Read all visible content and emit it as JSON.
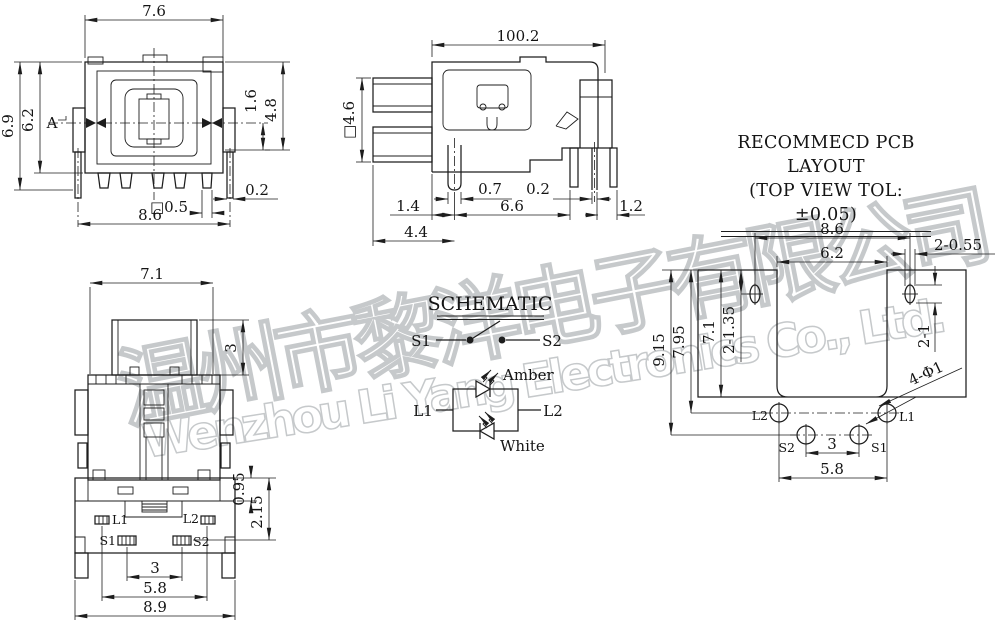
{
  "style": {
    "line_color": "#1d1d1d",
    "watermark_color": "#c6c9cb",
    "background": "#ffffff"
  },
  "watermark": {
    "zh": "温州市黎洋电子有限公司",
    "en": "Wenzhou Li Yang Electronics Co., Ltd."
  },
  "front_view": {
    "dim_top_width": "7.6",
    "dim_total_height": "6.9",
    "dim_body_height": "6.2",
    "section_label": "A",
    "dim_pin_drop": "1.6",
    "dim_flange_height": "4.8",
    "dim_pin_width": "0.2",
    "dim_square_pin": "□0.5",
    "dim_pin_span": "8.6"
  },
  "side_view": {
    "dim_total_length": "100.2",
    "dim_square_button": "□4.6",
    "dim_post_width": "0.7",
    "dim_pin_thickness": "0.2",
    "dim_left_offset": "1.4",
    "dim_pin_pitch": "6.6",
    "dim_right_offset": "1.2",
    "dim_front_depth": "4.4"
  },
  "bottom_view": {
    "dim_top_width": "7.1",
    "dim_button_height": "3",
    "dim_led_row_offset": "0.95",
    "dim_switch_row_offset": "2.15",
    "dim_switch_pitch": "3",
    "dim_led_pitch": "5.8",
    "dim_base_width": "8.9",
    "pin_labels": {
      "l1": "L1",
      "l2": "L2",
      "s1": "S1",
      "s2": "S2"
    }
  },
  "schematic": {
    "title": "SCHEMATIC",
    "switch_left": "S1",
    "switch_right": "S2",
    "led_left": "L1",
    "led_right": "L2",
    "led_top_color": "Amber",
    "led_bottom_color": "White"
  },
  "pcb_layout": {
    "title_line1": "RECOMMECD PCB LAYOUT",
    "title_line2": "(TOP VIEW TOL:±0.05)",
    "dim_slot_span": "8.6",
    "dim_cavity_width": "6.2",
    "dim_slot_width": "2-0.55",
    "dim_total_depth": "9.15",
    "dim_led_row": "7.95",
    "dim_cavity_depth": "7.1",
    "dim_slot_row": "2-1.35",
    "dim_slot_height": "2-1",
    "dim_hole_size": "4-Φ1",
    "dim_switch_pitch": "3",
    "dim_led_pitch": "5.8",
    "hole_labels": {
      "l1": "L1",
      "l2": "L2",
      "s1": "S1",
      "s2": "S2"
    }
  }
}
